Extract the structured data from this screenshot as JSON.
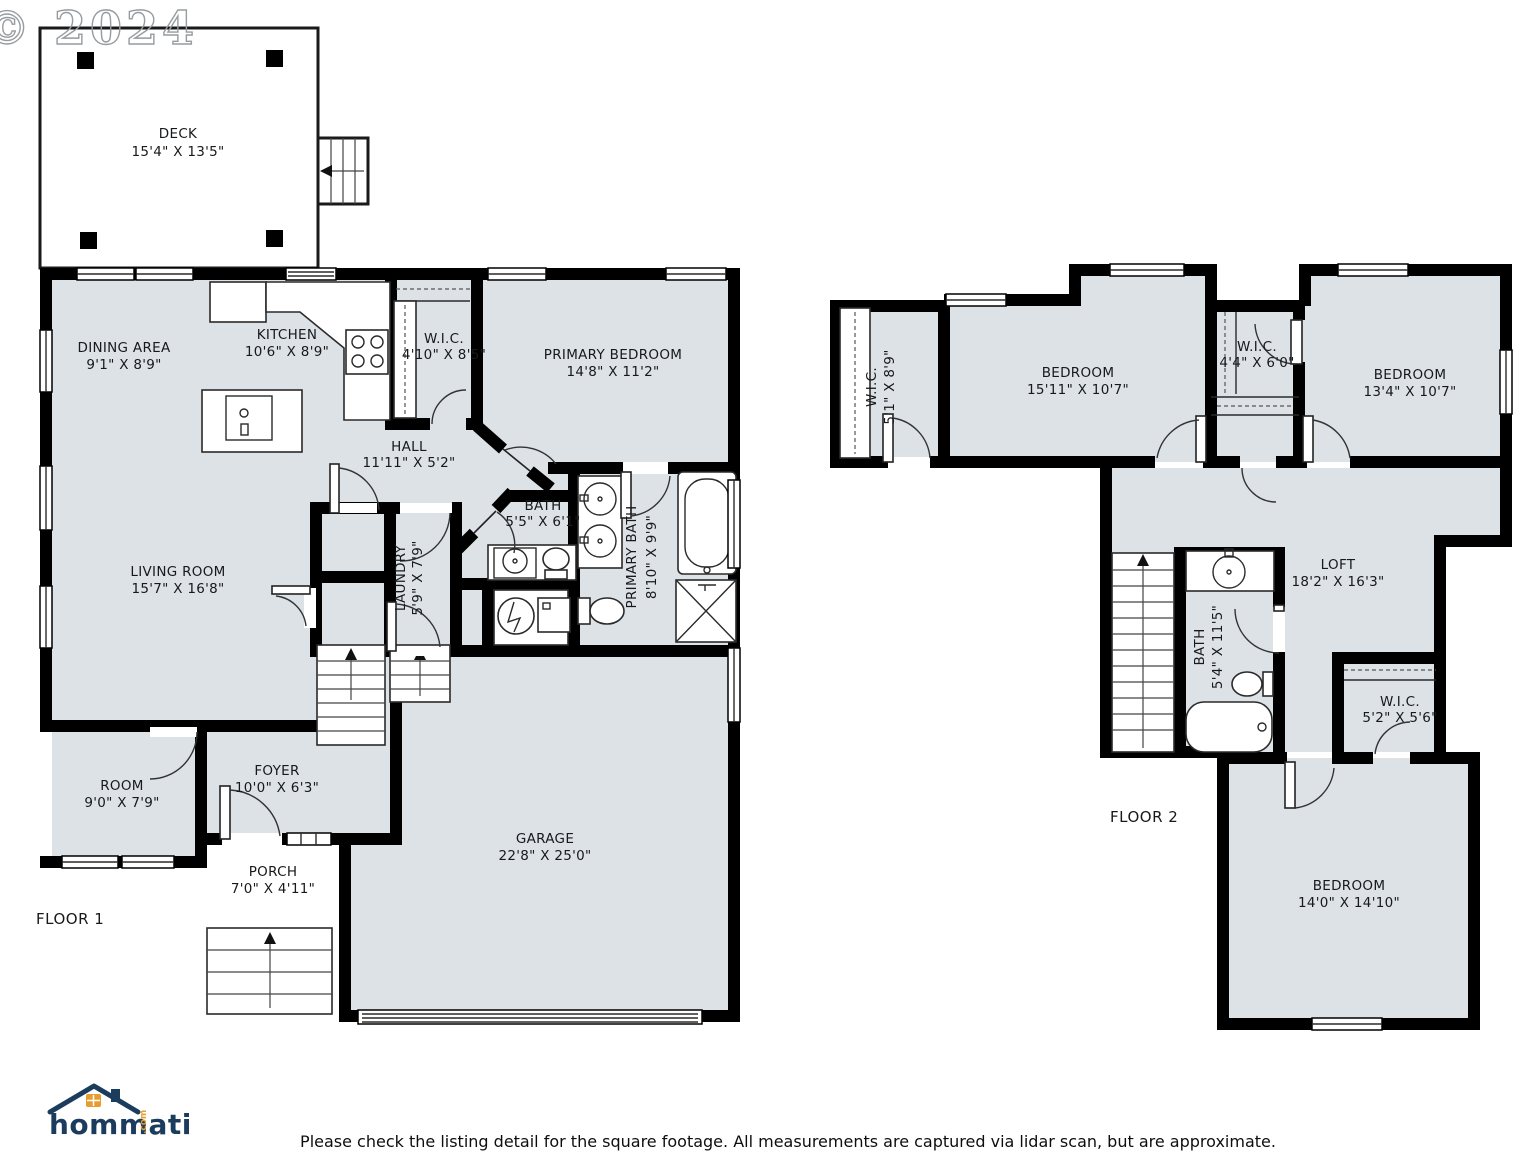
{
  "watermark": "© 2024",
  "floor1": {
    "label": "FLOOR 1",
    "deck": {
      "name": "DECK",
      "dims": "15'4\" X 13'5\""
    },
    "dining": {
      "name": "DINING AREA",
      "dims": "9'1\" X 8'9\""
    },
    "kitchen": {
      "name": "KITCHEN",
      "dims": "10'6\" X 8'9\""
    },
    "wic": {
      "name": "W.I.C.",
      "dims": "4'10\" X 8'5\""
    },
    "primary_bedroom": {
      "name": "PRIMARY BEDROOM",
      "dims": "14'8\" X 11'2\""
    },
    "hall": {
      "name": "HALL",
      "dims": "11'11\" X 5'2\""
    },
    "bath": {
      "name": "BATH",
      "dims": "5'5\" X 6'1\""
    },
    "primary_bath": {
      "name": "PRIMARY BATH",
      "dims": "8'10\" X 9'9\""
    },
    "living": {
      "name": "LIVING ROOM",
      "dims": "15'7\" X 16'8\""
    },
    "laundry": {
      "name": "LAUNDRY",
      "dims": "5'9\" X 7'9\""
    },
    "room": {
      "name": "ROOM",
      "dims": "9'0\" X 7'9\""
    },
    "foyer": {
      "name": "FOYER",
      "dims": "10'0\" X 6'3\""
    },
    "porch": {
      "name": "PORCH",
      "dims": "7'0\" X 4'11\""
    },
    "garage": {
      "name": "GARAGE",
      "dims": "22'8\" X 25'0\""
    }
  },
  "floor2": {
    "label": "FLOOR 2",
    "wic_left": {
      "name": "W.I.C.",
      "dims": "5'1\" X 8'9\""
    },
    "bedroom_left": {
      "name": "BEDROOM",
      "dims": "15'11\" X 10'7\""
    },
    "wic_mid": {
      "name": "W.I.C.",
      "dims": "4'4\" X 6'0\""
    },
    "bedroom_right": {
      "name": "BEDROOM",
      "dims": "13'4\" X 10'7\""
    },
    "loft": {
      "name": "LOFT",
      "dims": "18'2\" X 16'3\""
    },
    "bath": {
      "name": "BATH",
      "dims": "5'4\" X 11'5\""
    },
    "wic_loft": {
      "name": "W.I.C.",
      "dims": "5'2\" X 5'6\""
    },
    "bedroom_bottom": {
      "name": "BEDROOM",
      "dims": "14'0\" X 14'10\""
    }
  },
  "logo": {
    "brand": "hommati",
    "tld": ".com"
  },
  "disclaimer": "Please check the listing detail for the square footage. All measurements are captured via lidar scan, but are approximate.",
  "colors": {
    "room_fill": "#dde2e7",
    "wall": "#000000",
    "logo_navy": "#1c3c5e",
    "logo_orange": "#e89c30"
  }
}
